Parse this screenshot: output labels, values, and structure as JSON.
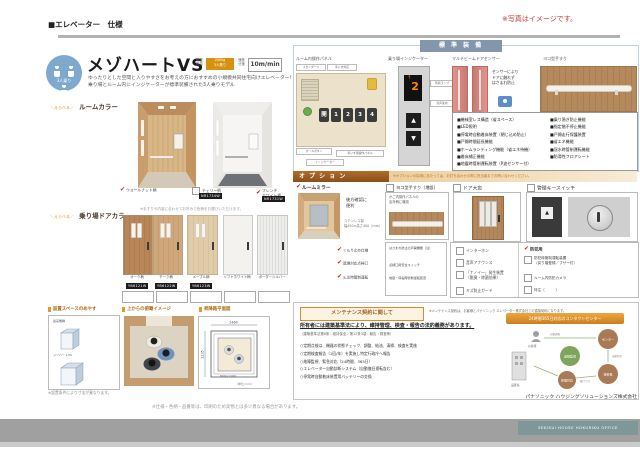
{
  "icons": {
    "check": "✔",
    "tri_up": "▲",
    "tri_down": "▼"
  },
  "header": {
    "title": "■エレベーター　仕様",
    "photo_note": "※写真はイメージです。"
  },
  "product": {
    "capacity_circle": "3人乗り",
    "title": "メゾハートVS",
    "spec1_label": "積載\n質量",
    "spec1_value": "200kg\n3人乗り",
    "spec2_label": "速度\n分速",
    "spec2_value": "10m/min",
    "description1": "ゆったりとした空間と入りやすさをお考えの方におすすめの小規模共同住宅向けエレベーター！",
    "description2": "乗り場とルーム内にインジケーターが標準装備された3人乗りモデル",
    "room_color": {
      "label_prefix": "＼えらべる／",
      "label": "ルームカラー",
      "options": [
        {
          "name": "ウォールナット柄",
          "code": ""
        },
        {
          "name": "チェリー柄",
          "code": "NR1734W"
        },
        {
          "name": "フレンチ\nホワイト柄",
          "code": "NR1731W"
        }
      ]
    },
    "door_color": {
      "label_prefix": "＼えらべる／",
      "label": "乗り場ドアカラー",
      "note": "※手すりや内装に合わせてお好みで色柄をお選びいただけます。",
      "options": [
        {
          "name": "オーク柄",
          "code": "YB6121W"
        },
        {
          "name": "チーク柄",
          "code": "YB6122W"
        },
        {
          "name": "メープル柄",
          "code": "YB6123W"
        },
        {
          "name": "ソフトホワイト柄",
          "code": ""
        },
        {
          "name": "ボーダーシルバー",
          "code": ""
        }
      ]
    },
    "space_box": {
      "title": "設置スペースのめやす",
      "item1": "従来機種",
      "item2": "メゾハートVS"
    },
    "overhead_title": "上からの俯瞰イメージ",
    "plan": {
      "title": "昇降路平面図",
      "dim_width": "1460",
      "dim_depth": "1235",
      "dim_inner": "800×1100",
      "unit": "（単位:mm）"
    }
  },
  "standard": {
    "header": "標 準 装 備",
    "col1_label": "ルーム内操作パネル",
    "col2_label": "乗り場インジケーター",
    "col3_label": "マルチビームドアセンサー",
    "col4_label": "ヨコ型手すり",
    "panel_tag1": "スタンダード",
    "panel_tag2": "車いす対応",
    "panel_keys": [
      "開",
      "1",
      "2",
      "3",
      "4"
    ],
    "panel_callout1": "ホールボタン",
    "panel_callout2": "インジケーター",
    "panel_callout3": "車いす用操作パネル",
    "indicator_floor": "2",
    "indicator_arrow": "↑",
    "indicator_callout1": "到着ランプ",
    "indicator_callout2": "音声案内",
    "sensor_caption": "センサーにより\nドアに触れず\nはさまれ防止",
    "features_left": [
      "■機械室レス構造（省スペース）",
      "■LED照明",
      "■停電時自動着床装置（閉じ込め防止）",
      "■戸開時間延長機能",
      "■ホームランディング機能（省エネ待機）",
      "■着床補正機能",
      "■地震時管制運転装置（P波センサー付）"
    ],
    "features_right": [
      "■乗り過ぎ防止機能",
      "■指定階不停止機能",
      "■戸開走行保護装置",
      "■省エネ機能",
      "■冠水時管制運転機能",
      "■防滑性フロアシート"
    ]
  },
  "options": {
    "header": "オ プ シ ョ ン",
    "note": "※オプションの採用にあたっては、お打ち合わせの際に担当者までお問い合わせください。",
    "mirror": {
      "label": "ルームミラー",
      "caption1": "後方確認に\n便利",
      "caption2": "ステンレス製\n幅450×高さ400（mm）",
      "checks": [
        "くもり止め仕様",
        "遮煙対応点検口",
        "火災時管制運転"
      ]
    },
    "handrail": {
      "label": "ヨコ型手すり（増設）",
      "caption": "かご内操作パネルの\n反対側に増設"
    },
    "door_window": {
      "label": "ドア大窓"
    },
    "key_switch": {
      "label": "管理キースイッチ"
    },
    "boxE": [
      "はさまれ防止の戸開機能（注）",
      "点検口用安全スイッチ",
      "地震・停電時管制運転装置"
    ],
    "list1": [
      "インターホン",
      "音声アナウンス",
      "「ナノイー」発生装置\n（脱臭・除菌効果）",
      "キズ防止ガード"
    ],
    "security_header": "防犯用",
    "list2": [
      "防犯時管制運転装置\n（戻り階登録／ブザー付）",
      "ルーム内防犯カメラ",
      "特注（　　　）"
    ]
  },
  "maintenance": {
    "button": "メンテナンス契約に関して",
    "note": "※メンテナンス契約は、お客様とパナソニック エレベーター株式会社との直接契約になります。",
    "duty": "所有者には建築基準法により、維持管理、検査・報告の法的義務があります。",
    "law": "（建築基準法第8条：維持保全／第12条3項：報告・検査等）",
    "items": [
      "○定期点検は、機器の状態チェック、調整、給油、清掃、検査を実施",
      "○定期検査報告（1回/年）を実施し特定行政庁へ報告",
      "○故障監視、緊急対応（24時間、365日）",
      "○エレベーター自動診断システム（自動復旧運転含む）",
      "○停電時自動着床装置用バッテリーの交換"
    ],
    "center_header": "24時間365日対応のコンタクトセンター",
    "diagram": {
      "customer": "お客様",
      "building": "設置先",
      "center": "遠隔監視",
      "contact": "センター",
      "service": "技術員",
      "repair": "修理対応",
      "a1": "自動通報",
      "a2": "出動指示",
      "a3": "駆けつけ"
    },
    "company": "パナソニック ハウジングソリューションズ株式会社"
  },
  "footer": {
    "note_left": "※設置条件により寸法が異なります。",
    "note_center": "※仕様・色柄・品番等は、印刷のため実物とは多少異なる場合があります。",
    "office": "SEKISUI HOUSE HOKURIKU OFFICE"
  }
}
